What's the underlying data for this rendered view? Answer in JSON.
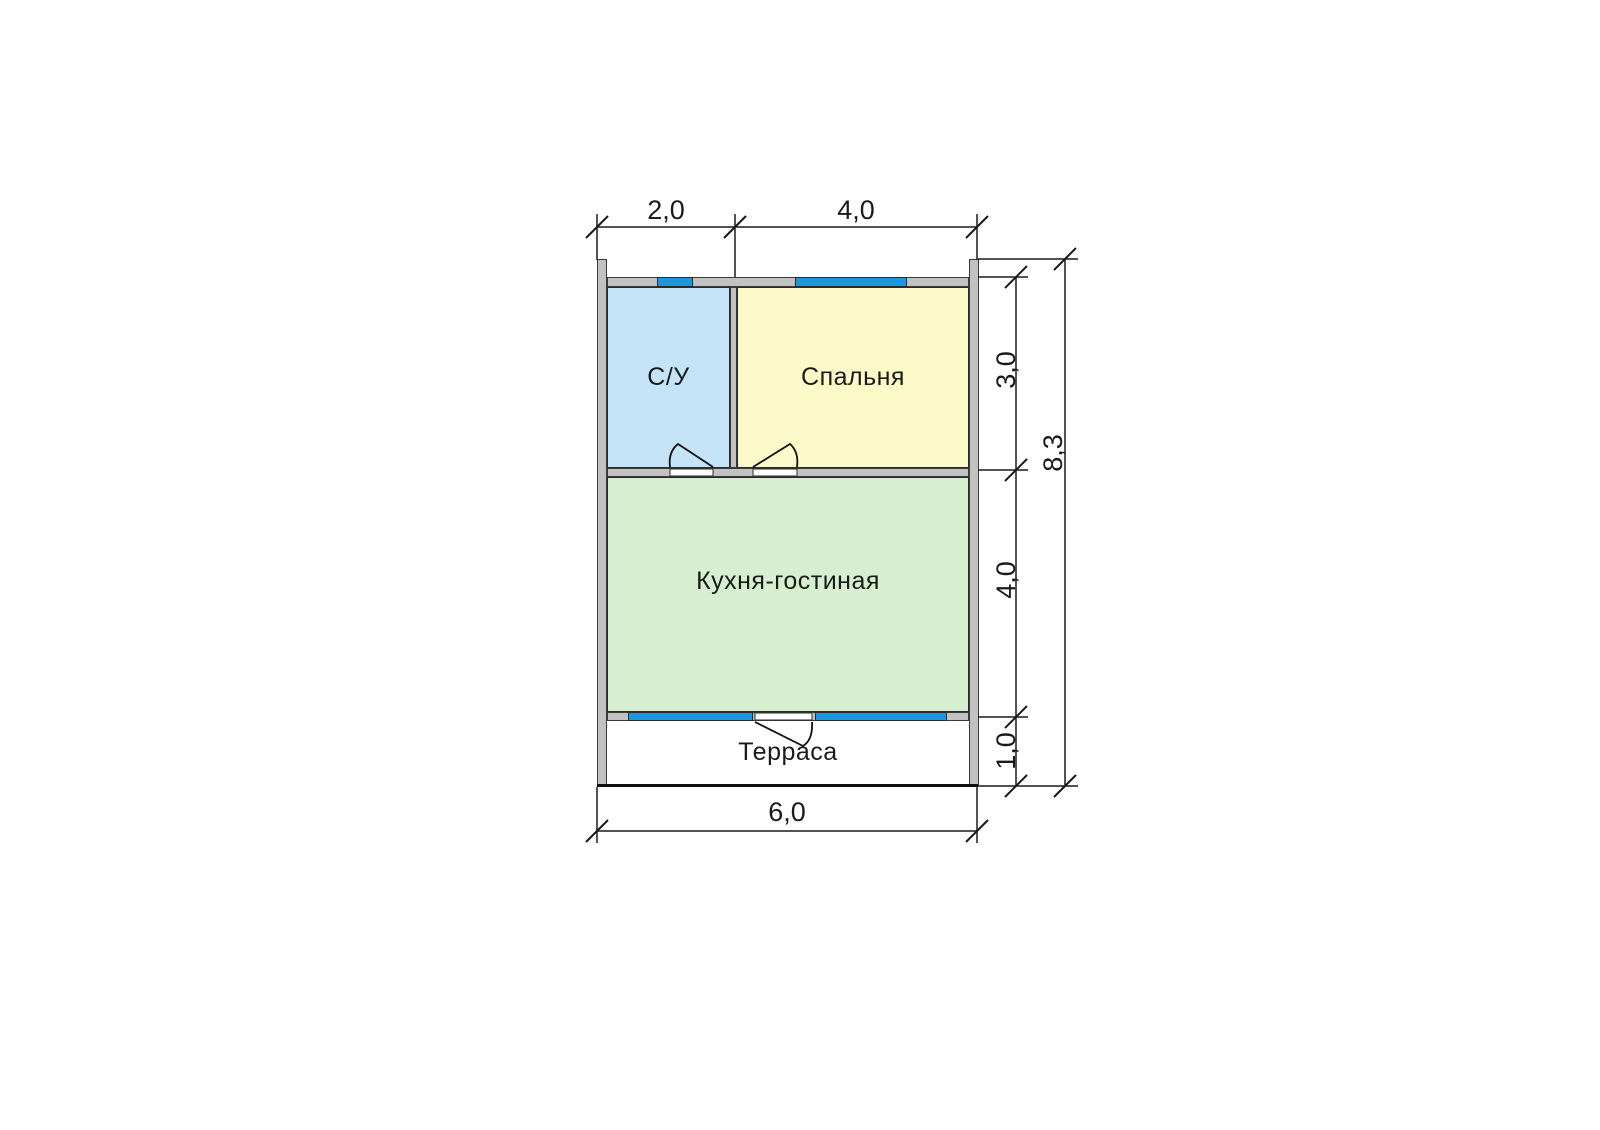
{
  "plan": {
    "type": "floor-plan",
    "rooms": [
      {
        "id": "su",
        "label": "С/У",
        "fill": "#c5e3f7"
      },
      {
        "id": "bedroom",
        "label": "Спальня",
        "fill": "#fcfac9"
      },
      {
        "id": "kitchen",
        "label": "Кухня-гостиная",
        "fill": "#d6f0cf"
      },
      {
        "id": "terrace",
        "label": "Терраса",
        "fill": "#ffffff"
      }
    ],
    "dimensions": {
      "top": [
        "2,0",
        "4,0"
      ],
      "right": [
        "3,0",
        "4,0",
        "1,0"
      ],
      "right_total": "8,3",
      "bottom": "6,0"
    },
    "colors": {
      "wall_fill": "#c2c2c2",
      "wall_outline": "#3a3a3a",
      "window_fill": "#1f97de",
      "line_color": "#1a1a1a",
      "background": "#ffffff"
    }
  }
}
